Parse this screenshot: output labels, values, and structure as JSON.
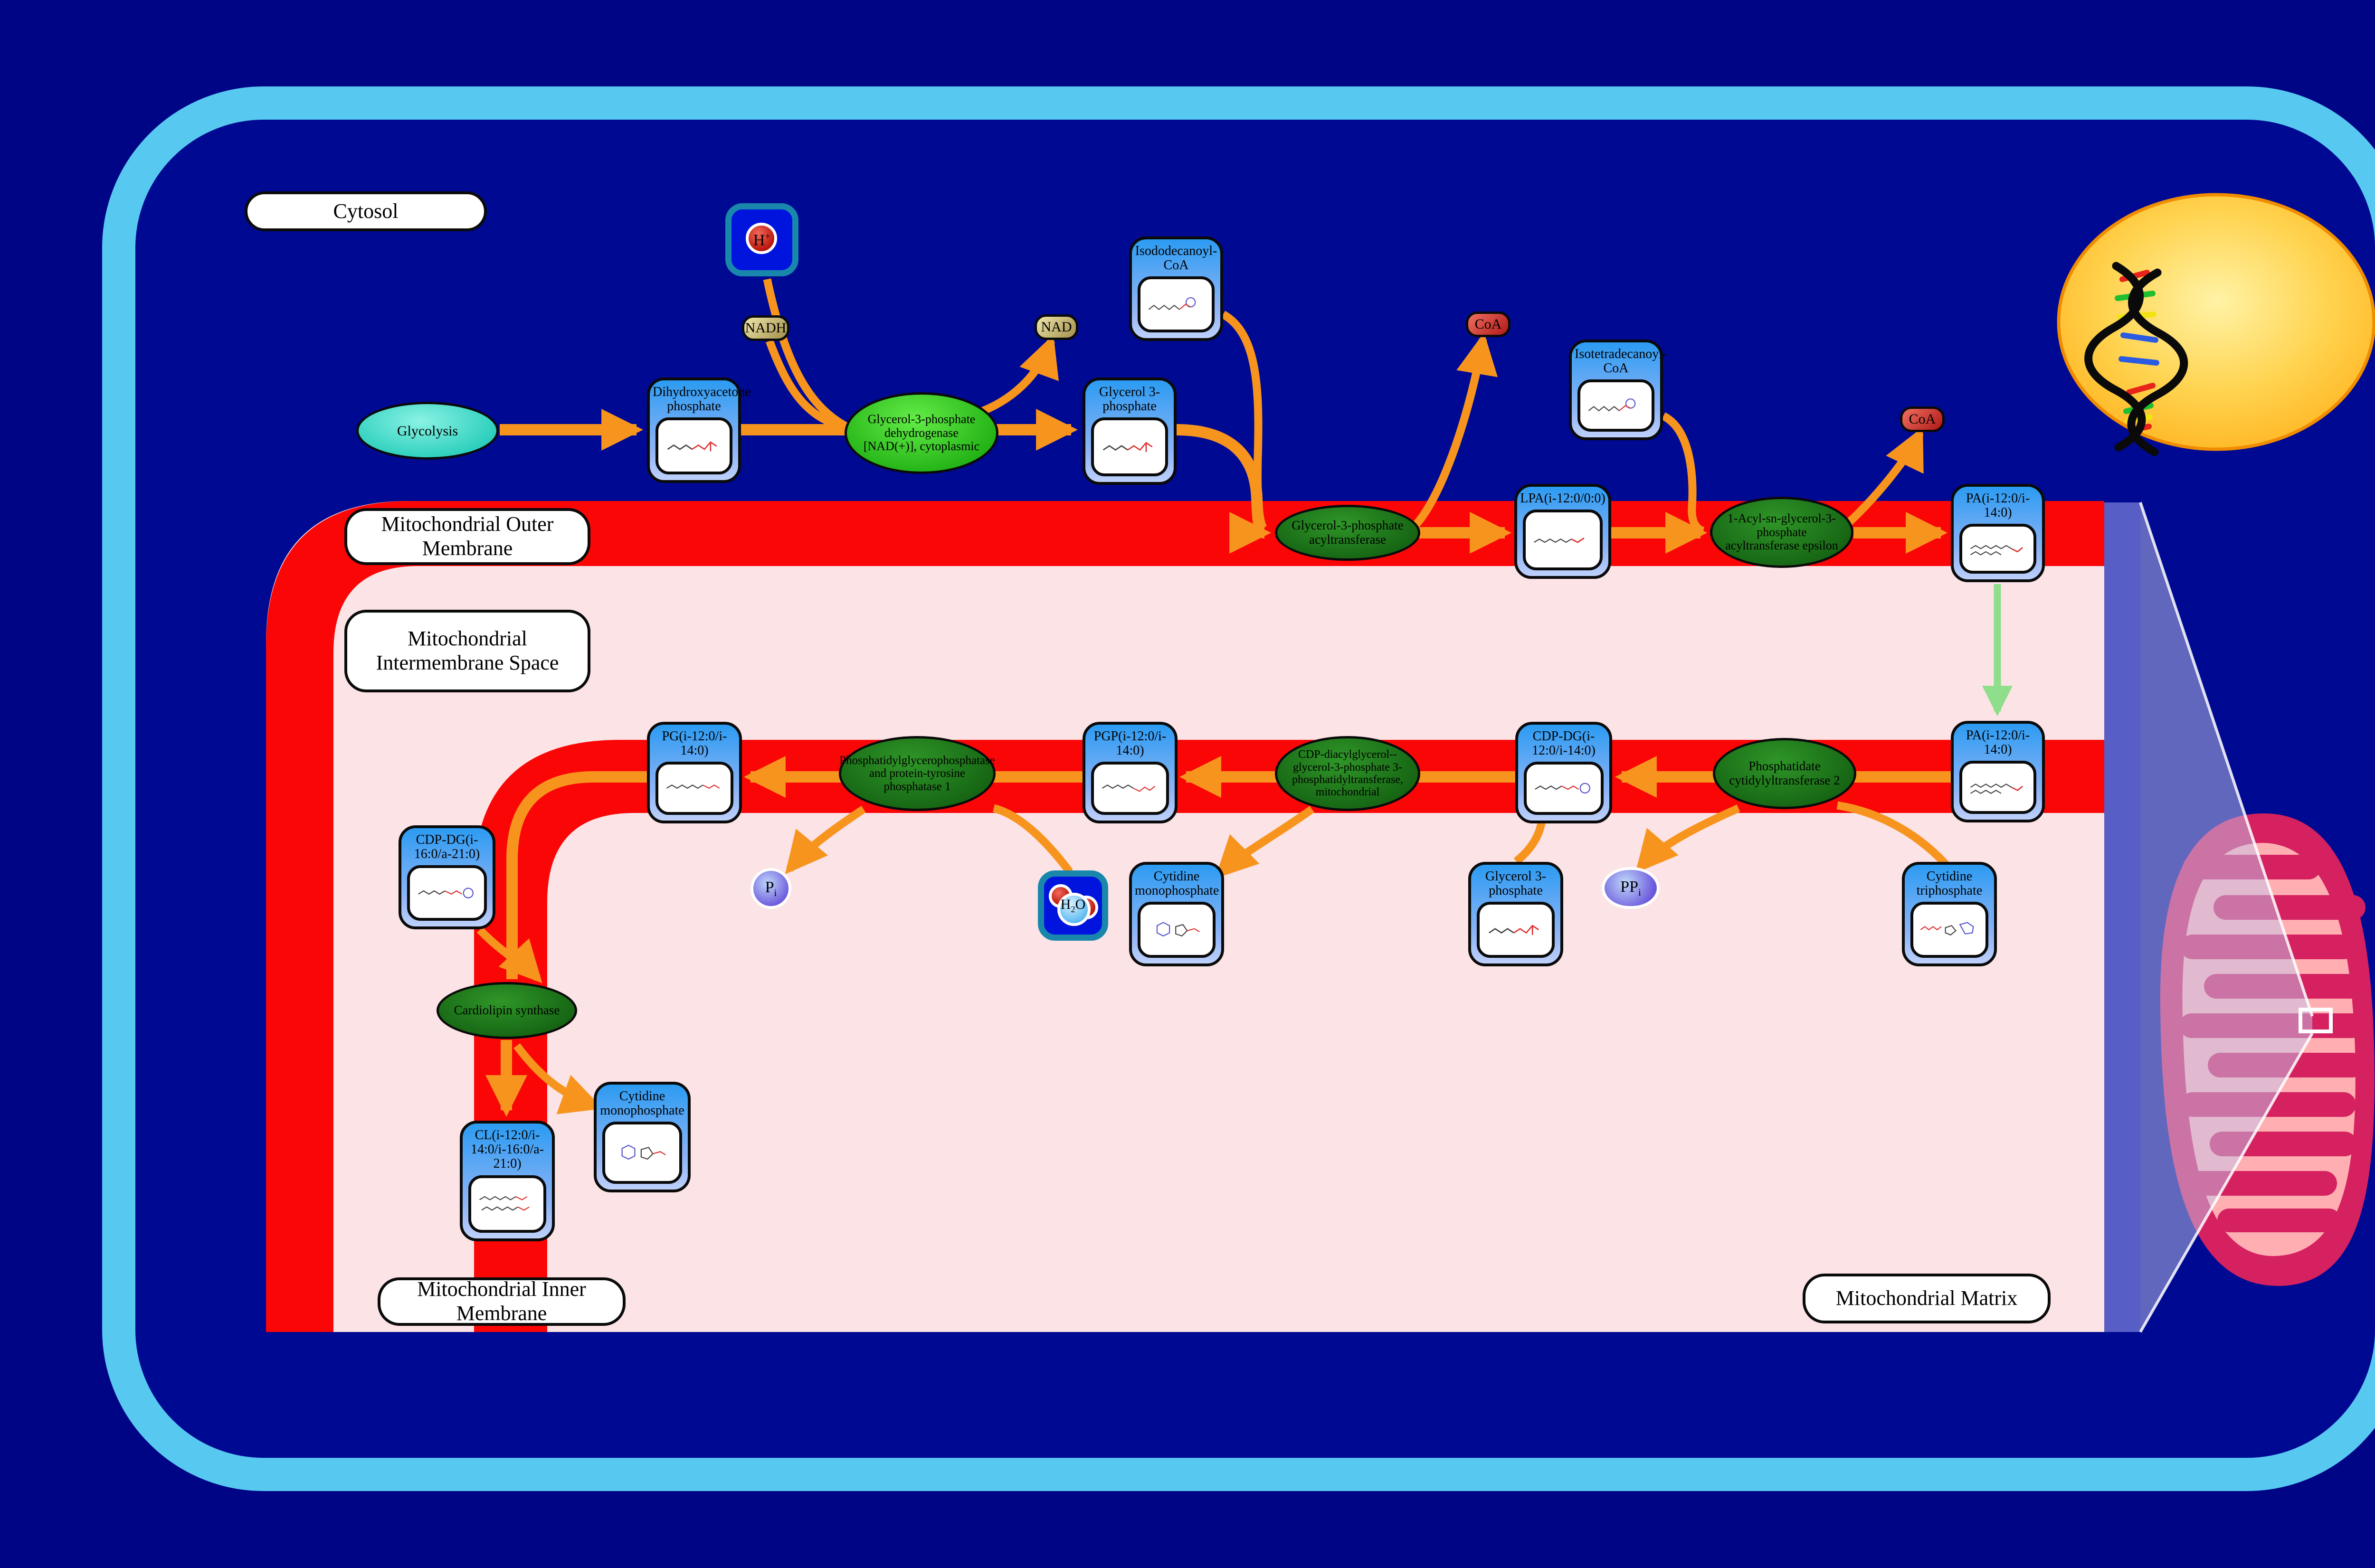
{
  "regions": {
    "cytosol": "Cytosol",
    "outer_membrane": "Mitochondrial Outer Membrane",
    "intermembrane_space": "Mitochondrial Intermembrane Space",
    "inner_membrane": "Mitochondrial Inner Membrane",
    "matrix": "Mitochondrial Matrix"
  },
  "process": {
    "glycolysis": "Glycolysis"
  },
  "enzymes": {
    "gpd1": "Glycerol-3-phosphate dehydrogenase [NAD(+)], cytoplasmic",
    "gpat": "Glycerol-3-phosphate acyltransferase",
    "agpat": "1-Acyl-sn-glycerol-3-phosphate acyltransferase epsilon",
    "cds2": "Phosphatidate cytidylyltransferase 2",
    "pgs1": "CDP-diacylglycerol--glycerol-3-phosphate 3-phosphatidyltransferase, mitochondrial",
    "ptpmt1": "Phosphatidylglycerophosphatase and protein-tyrosine phosphatase 1",
    "crls1": "Cardiolipin synthase"
  },
  "metabolites": {
    "dhap": "Dihydroxyacetone phosphate",
    "g3p": "Glycerol 3-phosphate",
    "isododecanoyl_coa": "Isododecanoyl-CoA",
    "lpa": "LPA(i-12:0/0:0)",
    "isotetradecanoyl_coa": "Isotetradecanoyl-CoA",
    "pa_outer": "PA(i-12:0/i-14:0)",
    "pa_inner": "PA(i-12:0/i-14:0)",
    "cdpdg": "CDP-DG(i-12:0/i-14:0)",
    "pgp": "PGP(i-12:0/i-14:0)",
    "pg": "PG(i-12:0/i-14:0)",
    "cdpdg2": "CDP-DG(i-16:0/a-21:0)",
    "cl": "CL(i-12:0/i-14:0/i-16:0/a-21:0)",
    "cmp_matrix": "Cytidine monophosphate",
    "cmp_inner": "Cytidine monophosphate",
    "g3p_small": "Glycerol 3-phosphate",
    "ctp": "Cytidine triphosphate"
  },
  "cofactors": {
    "nadh": "NADH",
    "nad": "NAD",
    "coa": "CoA",
    "proton_base": "H",
    "proton_charge": "+",
    "water_h": "H",
    "water_sub": "2",
    "water_o": "O",
    "pi_base": "P",
    "pi_sub": "i",
    "ppi_base": "PP",
    "ppi_sub": "i"
  },
  "colors": {
    "background": "#000586",
    "cell_border": "#57C8F0",
    "membrane_red": "#FA0606",
    "compartment_pink": "#FBE3E6",
    "arrow_orange": "#F7941E",
    "arrow_green": "#8EDE8B",
    "metabolite_blue": "#2B9BF2",
    "enzyme_green_bright": "#2FD31F",
    "enzyme_green_dark": "#1C7218",
    "nucleus_yellow": "#FFC53A",
    "mitochondrion_crimson": "#D5215F",
    "mitochondrion_pink": "#FFAEB2",
    "zoom_wedge_purple": "#5C63C8"
  }
}
